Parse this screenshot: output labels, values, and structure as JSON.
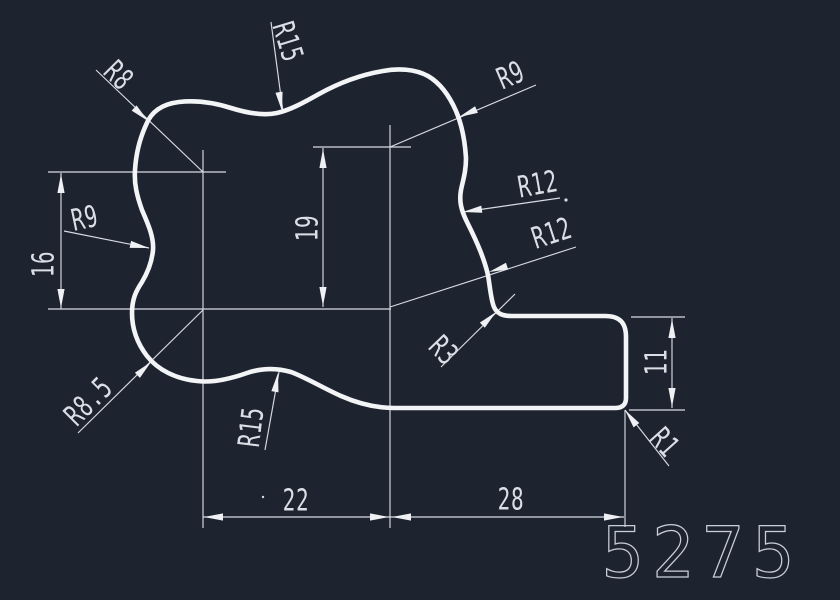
{
  "colors": {
    "background": "#1e2330",
    "geometry": "#f3f4f6",
    "dimensions": "#d7dbe2",
    "part_number_stroke": "#c9cfd8"
  },
  "dimensions": {
    "v16": "16",
    "v19": "19",
    "h22": "22",
    "h28": "28",
    "v11": "11"
  },
  "radius_labels": {
    "r8": "R8",
    "r15_top": "R15",
    "r9_top_right": "R9",
    "r9_left": "R9",
    "r12_upper": "R12",
    "r12_lower": "R12",
    "r3": "R3",
    "r1": "R1",
    "r8_5": "R8.5",
    "r15_bottom": "R15"
  },
  "part_number": "5275"
}
